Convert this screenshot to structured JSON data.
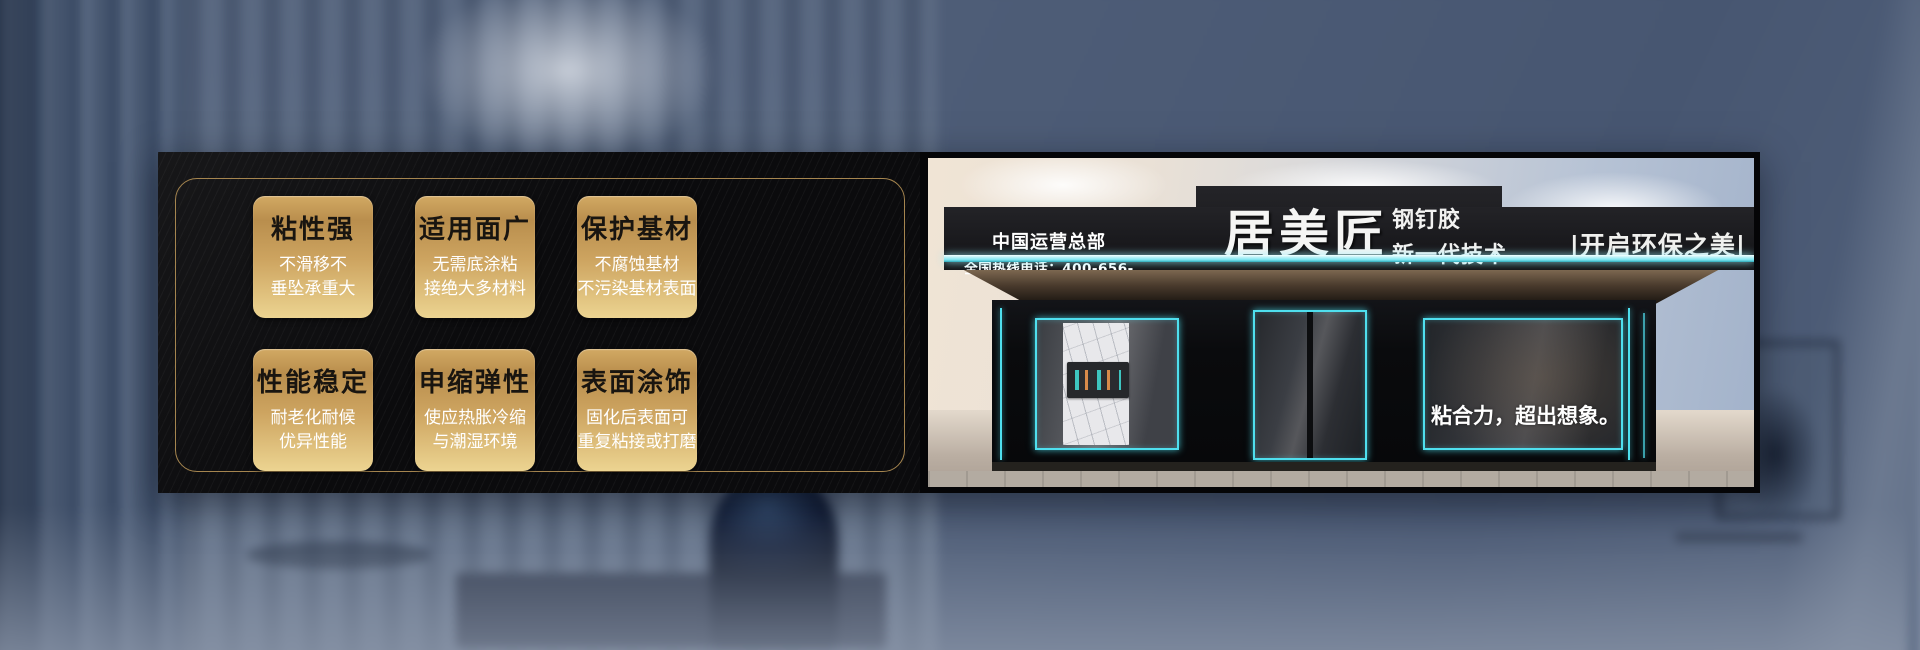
{
  "features": {
    "cards": [
      {
        "title": "粘性强",
        "line1": "不滑移不",
        "line2": "垂坠承重大"
      },
      {
        "title": "适用面广",
        "line1": "无需底涂粘",
        "line2": "接绝大多材料"
      },
      {
        "title": "保护基材",
        "line1": "不腐蚀基材",
        "line2": "不污染基材表面"
      },
      {
        "title": "性能稳定",
        "line1": "耐老化耐候",
        "line2": "优异性能"
      },
      {
        "title": "申缩弹性",
        "line1": "使应热胀冷缩",
        "line2": "与潮湿环境"
      },
      {
        "title": "表面涂饰",
        "line1": "固化后表面可",
        "line2": "重复粘接或打磨"
      }
    ]
  },
  "storefront": {
    "hq_title": "中国运营总部",
    "hotline": "全国热线电话：400-656-8678",
    "brand": "居美匠",
    "product_name": "钢钉胶",
    "product_tagline": "新一代技术",
    "eco_slogan": "|开启环保之美|",
    "window_slogan": "粘合力，超出想象。"
  },
  "colors": {
    "card_gold_top": "#d2a963",
    "card_gold_bottom": "#ecd491",
    "gold_border": "#a5854f",
    "led_cyan": "#4fdfee",
    "panel_black": "#0b0b0d",
    "card_title_text": "#191510",
    "card_subtitle_text": "#ffffff"
  }
}
